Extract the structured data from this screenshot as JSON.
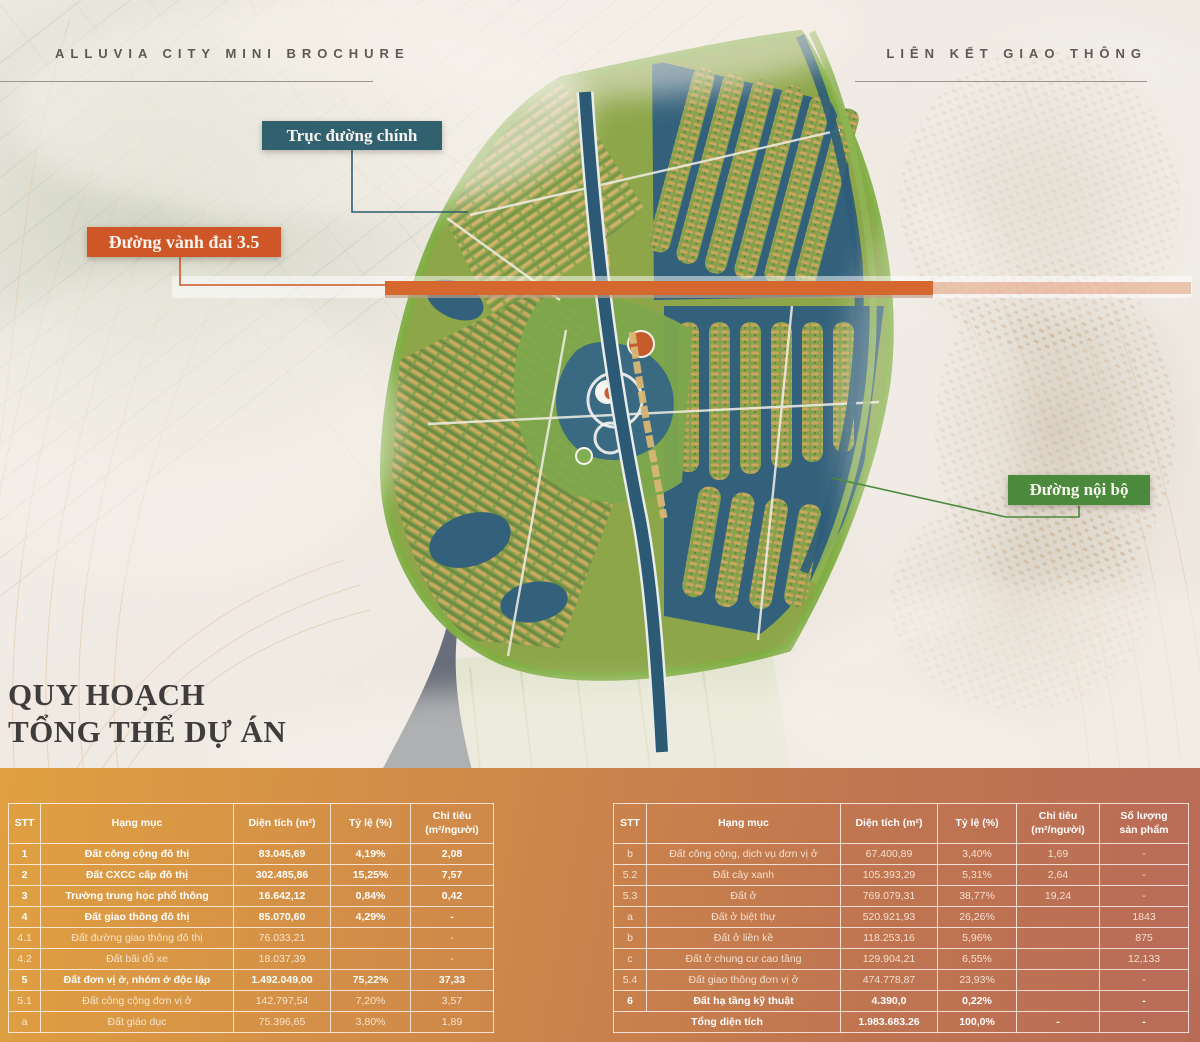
{
  "header": {
    "left_title": "ALLUVIA CITY MINI BROCHURE",
    "right_title": "LIÊN KẾT GIAO THÔNG"
  },
  "section_title": {
    "line1": "QUY HOẠCH",
    "line2": "TỔNG THỂ DỰ ÁN"
  },
  "map": {
    "callouts": [
      {
        "id": "callout-main-axis",
        "label": "Trục đường chính",
        "color": "#31606f"
      },
      {
        "id": "callout-ring-road",
        "label": "Đường vành đai 3.5",
        "color": "#cf5627"
      },
      {
        "id": "callout-internal-road",
        "label": "Đường nội bộ",
        "color": "#4b8a3c"
      }
    ]
  },
  "colors": {
    "accent_teal": "#31606f",
    "accent_orange": "#cf5627",
    "accent_green": "#4b8a3c",
    "band_gradient_left": "#e0a041",
    "band_gradient_right": "#b96b57",
    "water": "#33617b",
    "road": "#2c5a74"
  },
  "tables": {
    "left": {
      "columns": [
        "STT",
        "Hạng mục",
        "Diện tích (m²)",
        "Tỷ lệ (%)",
        "Chỉ tiêu\n(m²/người)"
      ],
      "rows": [
        {
          "stt": "1",
          "name": "Đất công cộng đô thị",
          "area": "83.045,69",
          "ratio": "4,19%",
          "target": "2,08",
          "style": "bold"
        },
        {
          "stt": "2",
          "name": "Đất CXCC cấp đô thị",
          "area": "302.485,86",
          "ratio": "15,25%",
          "target": "7,57",
          "style": "bold"
        },
        {
          "stt": "3",
          "name": "Trường trung học phổ thông",
          "area": "16.642,12",
          "ratio": "0,84%",
          "target": "0,42",
          "style": "bold"
        },
        {
          "stt": "4",
          "name": "Đất giao thông đô thị",
          "area": "85.070,60",
          "ratio": "4,29%",
          "target": "-",
          "style": "bold"
        },
        {
          "stt": "4.1",
          "name": "Đất đường giao thông đô thị",
          "area": "76.033,21",
          "ratio": "",
          "target": "-",
          "style": "dim"
        },
        {
          "stt": "4.2",
          "name": "Đất bãi đỗ xe",
          "area": "18.037,39",
          "ratio": "",
          "target": "-",
          "style": "dim"
        },
        {
          "stt": "5",
          "name": "Đất đơn vị ở, nhóm ở độc lập",
          "area": "1.492.049,00",
          "ratio": "75,22%",
          "target": "37,33",
          "style": "bold"
        },
        {
          "stt": "5.1",
          "name": "Đất công cộng đơn vị ở",
          "area": "142.797,54",
          "ratio": "7,20%",
          "target": "3,57",
          "style": "dim"
        },
        {
          "stt": "a",
          "name": "Đất giáo dục",
          "area": "75.396,65",
          "ratio": "3,80%",
          "target": "1,89",
          "style": "dim"
        }
      ]
    },
    "right": {
      "columns": [
        "STT",
        "Hạng mục",
        "Diện tích (m²)",
        "Tỷ lệ (%)",
        "Chỉ tiêu\n(m²/người)",
        "Số lượng\nsản phẩm"
      ],
      "rows": [
        {
          "stt": "b",
          "name": "Đất công cộng, dịch vụ đơn vị ở",
          "area": "67.400,89",
          "ratio": "3,40%",
          "target": "1,69",
          "qty": "-",
          "style": "dim"
        },
        {
          "stt": "5.2",
          "name": "Đất cây xanh",
          "area": "105.393,29",
          "ratio": "5,31%",
          "target": "2,64",
          "qty": "-",
          "style": "dim"
        },
        {
          "stt": "5.3",
          "name": "Đất ở",
          "area": "769.079,31",
          "ratio": "38,77%",
          "target": "19,24",
          "qty": "-",
          "style": "dim"
        },
        {
          "stt": "a",
          "name": "Đất ở biệt thự",
          "area": "520.921,93",
          "ratio": "26,26%",
          "target": "",
          "qty": "1843",
          "style": "dim"
        },
        {
          "stt": "b",
          "name": "Đất ở liền kề",
          "area": "118.253,16",
          "ratio": "5,96%",
          "target": "",
          "qty": "875",
          "style": "dim"
        },
        {
          "stt": "c",
          "name": "Đất ở chung cư cao tầng",
          "area": "129.904,21",
          "ratio": "6,55%",
          "target": "",
          "qty": "12,133",
          "style": "dim"
        },
        {
          "stt": "5.4",
          "name": "Đất giao thông đơn vị ở",
          "area": "474.778,87",
          "ratio": "23,93%",
          "target": "",
          "qty": "-",
          "style": "dim"
        },
        {
          "stt": "6",
          "name": "Đất hạ tầng kỹ thuật",
          "area": "4.390,0",
          "ratio": "0,22%",
          "target": "",
          "qty": "-",
          "style": "bold"
        },
        {
          "stt": "",
          "name": "Tổng diện tích",
          "area": "1.983.683.26",
          "ratio": "100,0%",
          "target": "-",
          "qty": "-",
          "style": "total"
        }
      ]
    }
  }
}
